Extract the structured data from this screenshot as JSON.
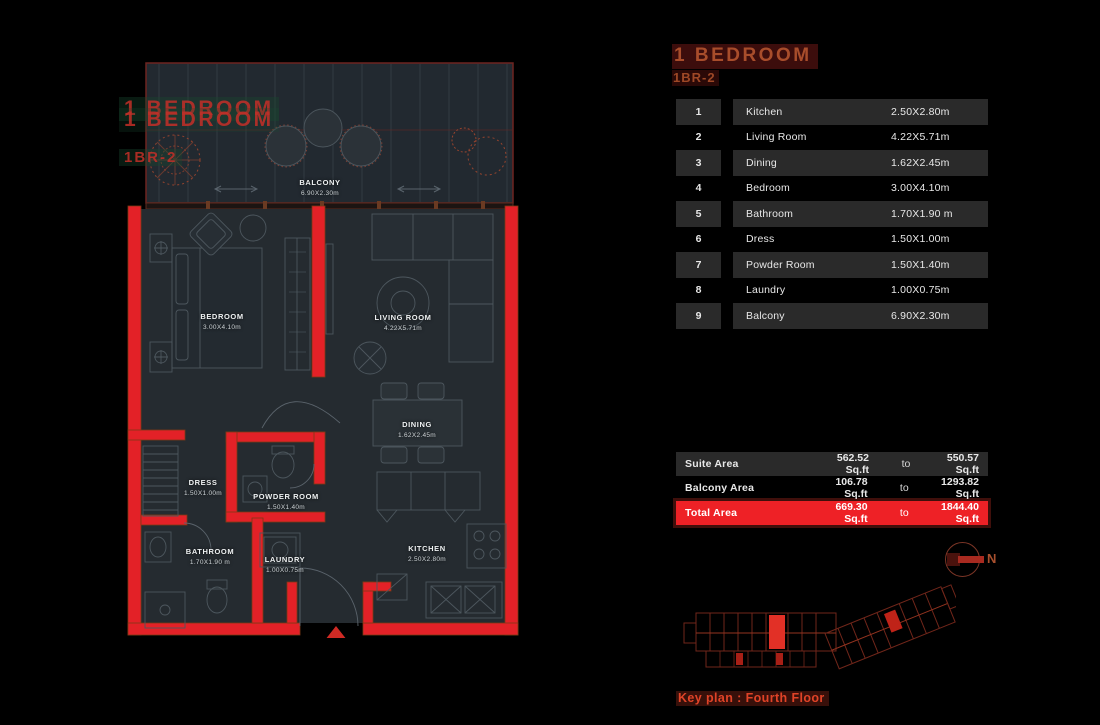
{
  "header": {
    "title": "1 BEDROOM",
    "code": "1BR-2"
  },
  "rooms_table": {
    "rows": [
      {
        "no": "1",
        "name": "Kitchen",
        "dim": "2.50X2.80m"
      },
      {
        "no": "2",
        "name": "Living Room",
        "dim": "4.22X5.71m"
      },
      {
        "no": "3",
        "name": "Dining",
        "dim": "1.62X2.45m"
      },
      {
        "no": "4",
        "name": "Bedroom",
        "dim": "3.00X4.10m"
      },
      {
        "no": "5",
        "name": "Bathroom",
        "dim": "1.70X1.90 m"
      },
      {
        "no": "6",
        "name": "Dress",
        "dim": "1.50X1.00m"
      },
      {
        "no": "7",
        "name": "Powder Room",
        "dim": "1.50X1.40m"
      },
      {
        "no": "8",
        "name": "Laundry",
        "dim": "1.00X0.75m"
      },
      {
        "no": "9",
        "name": "Balcony",
        "dim": "6.90X2.30m"
      }
    ]
  },
  "area_table": {
    "rows": [
      {
        "label": "Suite Area",
        "from": "562.52 Sq.ft",
        "word": "to",
        "to": "550.57 Sq.ft"
      },
      {
        "label": "Balcony Area",
        "from": "106.78 Sq.ft",
        "word": "to",
        "to": "1293.82 Sq.ft"
      },
      {
        "label": "Total Area",
        "from": "669.30 Sq.ft",
        "word": "to",
        "to": "1844.40 Sq.ft"
      }
    ]
  },
  "plan": {
    "labels": [
      {
        "name": "BALCONY",
        "dim": "6.90X2.30m"
      },
      {
        "name": "BEDROOM",
        "dim": "3.00X4.10m"
      },
      {
        "name": "LIVING ROOM",
        "dim": "4.22X5.71m"
      },
      {
        "name": "DINING",
        "dim": "1.62X2.45m"
      },
      {
        "name": "DRESS",
        "dim": "1.50X1.00m"
      },
      {
        "name": "POWDER ROOM",
        "dim": "1.50X1.40m"
      },
      {
        "name": "BATHROOM",
        "dim": "1.70X1.90 m"
      },
      {
        "name": "LAUNDRY",
        "dim": "1.00X0.75m"
      },
      {
        "name": "KITCHEN",
        "dim": "2.50X2.80m"
      }
    ],
    "watermark": {
      "line": "1 BEDROOM",
      "code": "1BR-2"
    }
  },
  "compass": {
    "north_label": "N"
  },
  "key_plan": {
    "caption": "Key plan : Fourth Floor"
  },
  "colors": {
    "wall_red": "#e32127",
    "accent_red": "#ee2126",
    "title_text": "#a84d2b",
    "caption_text": "#e04327"
  }
}
